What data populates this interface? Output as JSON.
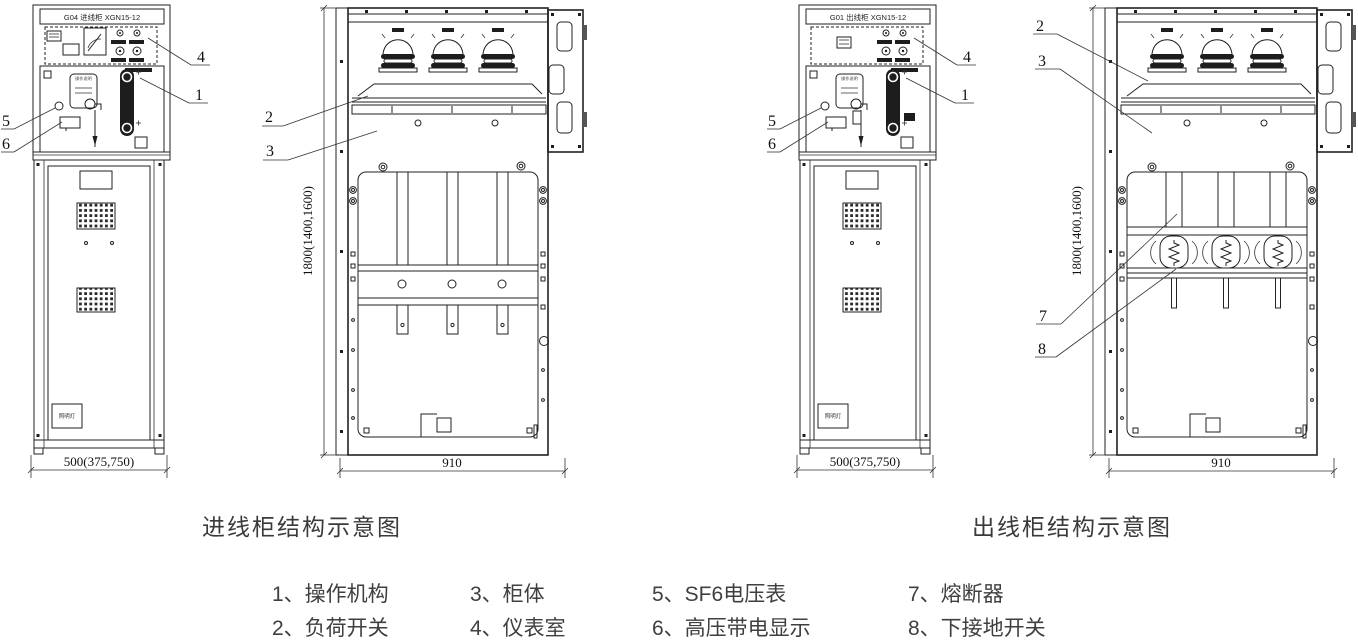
{
  "incoming": {
    "front": {
      "title": "G04  进线柜  XGN15-12",
      "plate_label": "操作说明",
      "lamp_label": "照明灯",
      "width_dim": "500(375,750)"
    },
    "internal": {
      "height_dim": "1800(1400,1600)",
      "width_dim": "910"
    },
    "caption": "进线柜结构示意图",
    "callouts": {
      "mechanism": "1",
      "load_switch": "2",
      "cabinet_body": "3",
      "instrument": "4",
      "sf6_gauge": "5",
      "hv_display": "6"
    }
  },
  "outgoing": {
    "front": {
      "title": "G01  出线柜  XGN15-12",
      "plate_label": "操作说明",
      "lamp_label": "照明灯",
      "width_dim": "500(375,750)"
    },
    "internal": {
      "height_dim": "1800(1400,1600)",
      "width_dim": "910"
    },
    "caption": "出线柜结构示意图",
    "callouts": {
      "mechanism": "1",
      "load_switch": "2",
      "cabinet_body": "3",
      "instrument": "4",
      "sf6_gauge": "5",
      "hv_display": "6",
      "fuse": "7",
      "earth_switch": "8"
    }
  },
  "legend": {
    "items": [
      "1、操作机构",
      "2、负荷开关",
      "3、柜体",
      "4、仪表室",
      "5、SF6电压表",
      "6、高压带电显示",
      "7、熔断器",
      "8、下接地开关"
    ]
  }
}
